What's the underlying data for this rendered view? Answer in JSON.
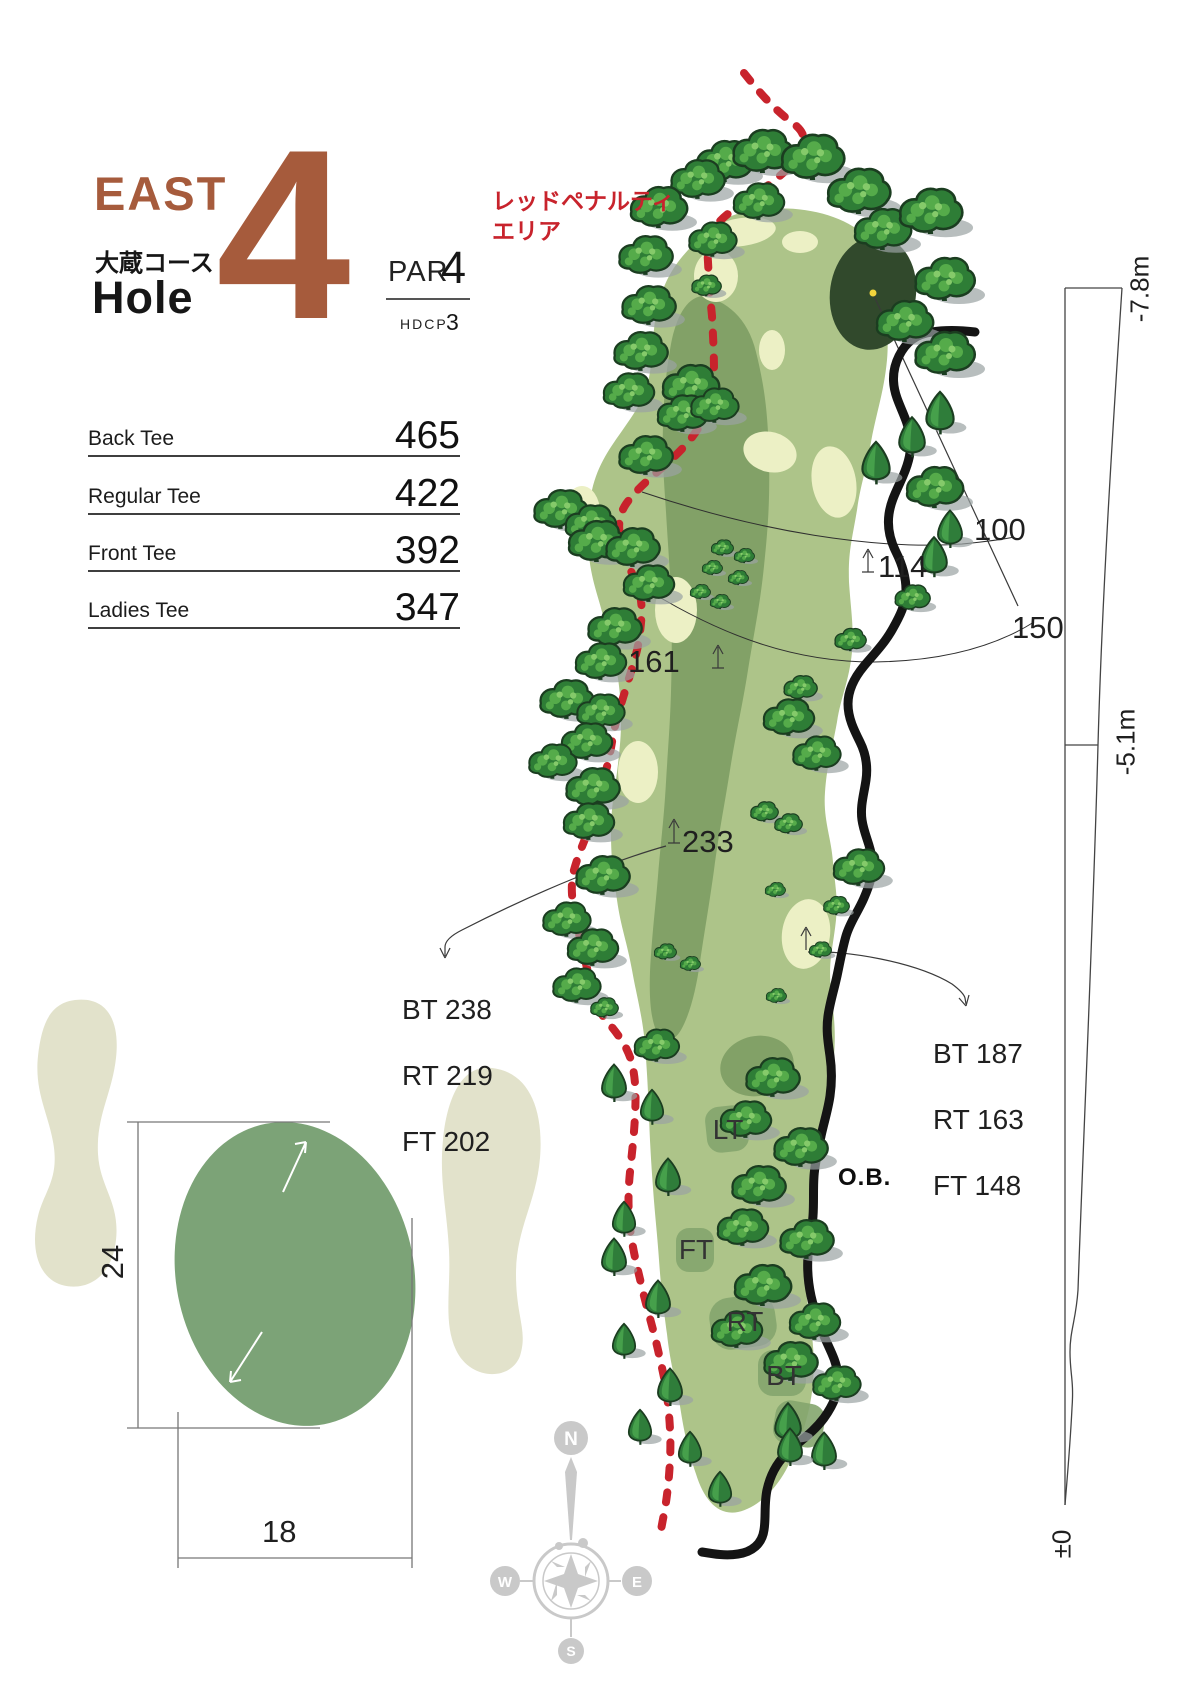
{
  "header": {
    "region": "EAST",
    "course": "大蔵コース",
    "hole_word": "Hole",
    "hole_number": "4",
    "par_label": "PAR",
    "par_value": "4",
    "hdcp_label": "HDCP",
    "hdcp_value": "3"
  },
  "tee_table": {
    "rows": [
      {
        "label": "Back Tee",
        "value": "465"
      },
      {
        "label": "Regular Tee",
        "value": "422"
      },
      {
        "label": "Front Tee",
        "value": "392"
      },
      {
        "label": "Ladies Tee",
        "value": "347"
      }
    ]
  },
  "hazard": {
    "penalty_line1": "レッドペナルティ",
    "penalty_line2": "エリア",
    "ob": "O.B."
  },
  "distances": {
    "d100": "100",
    "d150": "150",
    "d114": "114",
    "d161": "161",
    "d233": "233"
  },
  "carry_left": {
    "bt": "BT 238",
    "rt": "RT 219",
    "ft": "FT 202"
  },
  "carry_right": {
    "bt": "BT 187",
    "rt": "RT 163",
    "ft": "FT 148"
  },
  "tee_marks": {
    "lt": "LT",
    "ft": "FT",
    "rt": "RT",
    "bt": "BT"
  },
  "green_detail": {
    "depth": "24",
    "width": "18"
  },
  "elevation": {
    "green": "-7.8m",
    "mid": "-5.1m",
    "tee": "±0"
  },
  "compass": {
    "n": "N",
    "e": "E",
    "s": "S",
    "w": "W"
  },
  "colors": {
    "ink": "#1d1d1d",
    "accent": "#a65b3c",
    "red": "#c8232c",
    "fairway": "#adc489",
    "fairway_dark": "#82a167",
    "pale": "#ecf0c5",
    "green": "#31492c",
    "pin": "#f2d43c",
    "sand": "#e2e2cb",
    "detail_green": "#7ca377",
    "pad": "#84a56e",
    "tree_dark": "#1b3d20",
    "tree_mid": "#2e7d36",
    "tree_light": "#55ab4a",
    "tree_lighter": "#85ca6a",
    "shadow": "#9aa3a3",
    "compass": "#c9c9c9"
  },
  "map": {
    "trees": [
      [
        724,
        162,
        "b",
        0.95
      ],
      [
        762,
        152,
        "b",
        1
      ],
      [
        812,
        158,
        "b",
        1.05
      ],
      [
        758,
        202,
        "b",
        0.85
      ],
      [
        858,
        192,
        "b",
        1.05
      ],
      [
        882,
        230,
        "b",
        0.95
      ],
      [
        697,
        180,
        "b",
        0.9
      ],
      [
        930,
        212,
        "b",
        1.05
      ],
      [
        944,
        280,
        "b",
        1
      ],
      [
        904,
        322,
        "b",
        0.95
      ],
      [
        944,
        354,
        "b",
        1
      ],
      [
        940,
        414,
        "c",
        0.85
      ],
      [
        912,
        438,
        "c",
        0.8
      ],
      [
        876,
        464,
        "c",
        0.85
      ],
      [
        934,
        488,
        "b",
        0.95
      ],
      [
        950,
        530,
        "c",
        0.75
      ],
      [
        934,
        558,
        "c",
        0.8
      ],
      [
        912,
        598,
        "s",
        0.95
      ],
      [
        850,
        640,
        "s",
        0.85
      ],
      [
        800,
        688,
        "s",
        0.9
      ],
      [
        788,
        718,
        "b",
        0.85
      ],
      [
        816,
        754,
        "b",
        0.8
      ],
      [
        764,
        812,
        "s",
        0.75
      ],
      [
        788,
        824,
        "s",
        0.75
      ],
      [
        858,
        868,
        "b",
        0.85
      ],
      [
        836,
        906,
        "s",
        0.7
      ],
      [
        820,
        950,
        "s",
        0.6
      ],
      [
        775,
        890,
        "s",
        0.55
      ],
      [
        776,
        996,
        "s",
        0.55
      ],
      [
        772,
        1078,
        "b",
        0.9
      ],
      [
        745,
        1120,
        "b",
        0.85
      ],
      [
        800,
        1148,
        "b",
        0.9
      ],
      [
        758,
        1186,
        "b",
        0.9
      ],
      [
        742,
        1228,
        "b",
        0.85
      ],
      [
        806,
        1240,
        "b",
        0.9
      ],
      [
        762,
        1286,
        "b",
        0.95
      ],
      [
        736,
        1330,
        "b",
        0.85
      ],
      [
        814,
        1322,
        "b",
        0.85
      ],
      [
        790,
        1362,
        "b",
        0.9
      ],
      [
        836,
        1384,
        "b",
        0.8
      ],
      [
        788,
        1424,
        "c",
        0.8
      ],
      [
        824,
        1452,
        "c",
        0.75
      ],
      [
        658,
        208,
        "b",
        0.95
      ],
      [
        645,
        256,
        "b",
        0.9
      ],
      [
        712,
        240,
        "b",
        0.8
      ],
      [
        648,
        306,
        "b",
        0.9
      ],
      [
        706,
        286,
        "s",
        0.8
      ],
      [
        640,
        352,
        "b",
        0.9
      ],
      [
        628,
        392,
        "b",
        0.85
      ],
      [
        690,
        386,
        "b",
        0.95
      ],
      [
        682,
        414,
        "b",
        0.85
      ],
      [
        714,
        406,
        "b",
        0.8
      ],
      [
        645,
        456,
        "b",
        0.9
      ],
      [
        560,
        510,
        "b",
        0.9
      ],
      [
        590,
        524,
        "b",
        0.85
      ],
      [
        596,
        542,
        "b",
        0.95
      ],
      [
        632,
        548,
        "b",
        0.9
      ],
      [
        648,
        584,
        "b",
        0.85
      ],
      [
        722,
        548,
        "s",
        0.6
      ],
      [
        744,
        556,
        "s",
        0.55
      ],
      [
        712,
        568,
        "s",
        0.55
      ],
      [
        738,
        578,
        "s",
        0.55
      ],
      [
        700,
        592,
        "s",
        0.55
      ],
      [
        720,
        602,
        "s",
        0.55
      ],
      [
        614,
        628,
        "b",
        0.9
      ],
      [
        600,
        662,
        "b",
        0.85
      ],
      [
        566,
        700,
        "b",
        0.9
      ],
      [
        600,
        712,
        "b",
        0.8
      ],
      [
        586,
        742,
        "b",
        0.85
      ],
      [
        552,
        762,
        "b",
        0.8
      ],
      [
        592,
        788,
        "b",
        0.9
      ],
      [
        588,
        822,
        "b",
        0.85
      ],
      [
        602,
        876,
        "b",
        0.9
      ],
      [
        566,
        920,
        "b",
        0.8
      ],
      [
        592,
        948,
        "b",
        0.85
      ],
      [
        576,
        986,
        "b",
        0.8
      ],
      [
        604,
        1008,
        "s",
        0.75
      ],
      [
        665,
        952,
        "s",
        0.6
      ],
      [
        690,
        964,
        "s",
        0.55
      ],
      [
        656,
        1046,
        "b",
        0.75
      ],
      [
        614,
        1084,
        "c",
        0.75
      ],
      [
        652,
        1108,
        "c",
        0.7
      ],
      [
        668,
        1178,
        "c",
        0.75
      ],
      [
        624,
        1220,
        "c",
        0.7
      ],
      [
        614,
        1258,
        "c",
        0.75
      ],
      [
        658,
        1300,
        "c",
        0.75
      ],
      [
        624,
        1342,
        "c",
        0.7
      ],
      [
        670,
        1388,
        "c",
        0.75
      ],
      [
        640,
        1428,
        "c",
        0.7
      ],
      [
        690,
        1450,
        "c",
        0.7
      ],
      [
        720,
        1490,
        "c",
        0.7
      ],
      [
        790,
        1448,
        "c",
        0.75
      ]
    ]
  }
}
